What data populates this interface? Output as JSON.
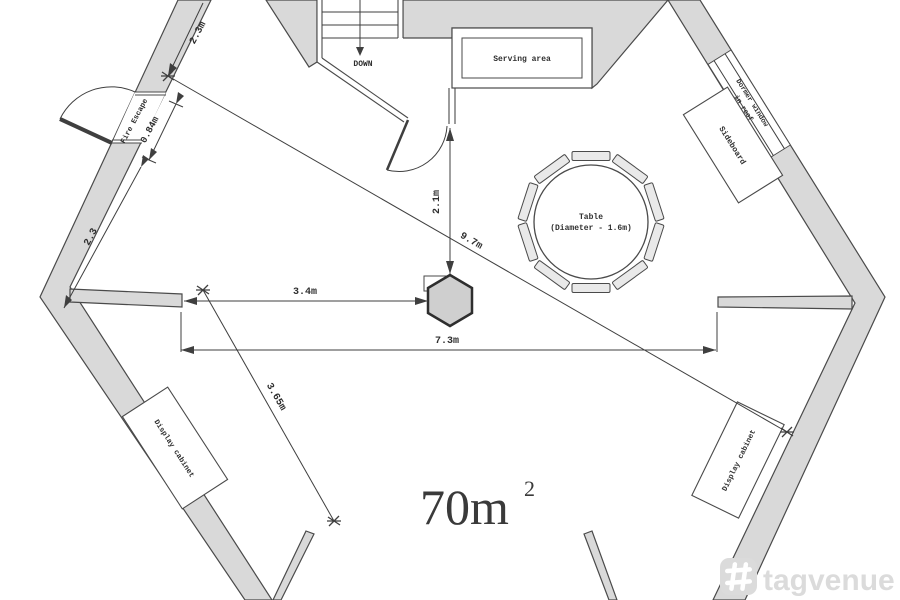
{
  "plan": {
    "area_label": {
      "value": "70m",
      "sup": "2"
    },
    "rooms": {
      "serving_area": "Serving area",
      "stairs_down": "DOWN"
    },
    "furniture": {
      "table_line1": "Table",
      "table_line2": "(Diameter - 1.6m)",
      "sideboard": "Sideboard",
      "display_cabinet_left": "Display cabinet",
      "display_cabinet_right": "Display cabinet"
    },
    "doors": {
      "fire_escape": "Fire Escape"
    },
    "windows": {
      "dormer_line1": "Dormer window",
      "dormer_line2": "in roof"
    },
    "dimensions": {
      "wall_top": "2.3m",
      "door_width": "0.84m",
      "wall_bottom": "2.3",
      "column_vertical": "2.1m",
      "diagonal_long": "9.7m",
      "column_offset": "3.4m",
      "room_width": "7.3m",
      "diagonal_short": "3.65m"
    }
  },
  "watermark": {
    "brand": "tagvenue"
  },
  "colors": {
    "wall_fill": "#d9d9d9",
    "wall_stroke": "#4a4a4a",
    "line": "#3f3f3f",
    "column_fill": "#cfcfcf",
    "watermark_gray": "#dbdbdb"
  }
}
